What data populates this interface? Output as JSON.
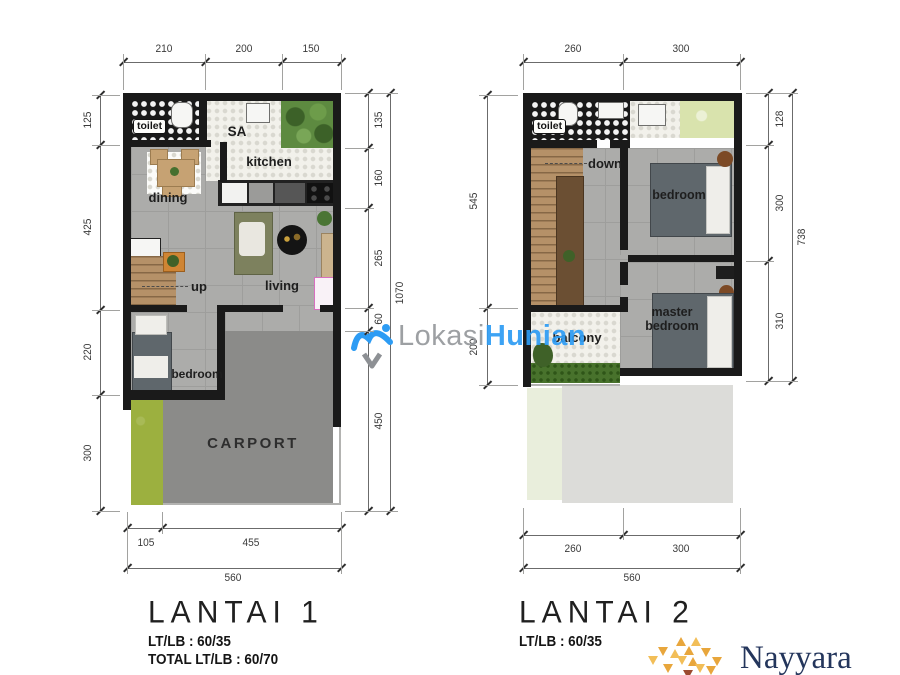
{
  "watermark": {
    "part1": "Lokasi",
    "part2": "Hunian"
  },
  "plan1": {
    "title": "LANTAI 1",
    "lt_lb": "LT/LB : 60/35",
    "total_lt_lb": "TOTAL LT/LB : 60/70",
    "rooms": {
      "toilet": "toilet",
      "sa": "SA",
      "kitchen": "kitchen",
      "dining": "dining",
      "up": "up",
      "living": "living",
      "bedroom": "bedroom",
      "carport": "CARPORT"
    },
    "dims": {
      "top": [
        "210",
        "200",
        "150"
      ],
      "left": [
        "125",
        "425",
        "220",
        "300"
      ],
      "right": [
        "135",
        "160",
        "265",
        "60",
        "450"
      ],
      "right_total": "1070",
      "bottom": [
        "105",
        "455"
      ],
      "bottom_total": "560"
    }
  },
  "plan2": {
    "title": "LANTAI 2",
    "lt_lb": "LT/LB : 60/35",
    "rooms": {
      "toilet": "toilet",
      "down": "down",
      "bedroom": "bedroom",
      "master": "master bedroom",
      "balcony": "balcony"
    },
    "dims": {
      "top": [
        "260",
        "300"
      ],
      "left": [
        "545",
        "200"
      ],
      "right": [
        "128",
        "300",
        "310"
      ],
      "right_total": "738",
      "bottom": [
        "260",
        "300"
      ],
      "bottom_total": "560"
    }
  },
  "logo": {
    "text": "Nayyara"
  },
  "colors": {
    "watermark_blue": "#2D9CF4",
    "watermark_gray": "#95989C",
    "logo_gold": "#E8A63C",
    "logo_navy": "#24365C",
    "wall": "#1A1A1A",
    "carport_gray": "#8B8B89",
    "grass_green": "#9CB03F"
  }
}
